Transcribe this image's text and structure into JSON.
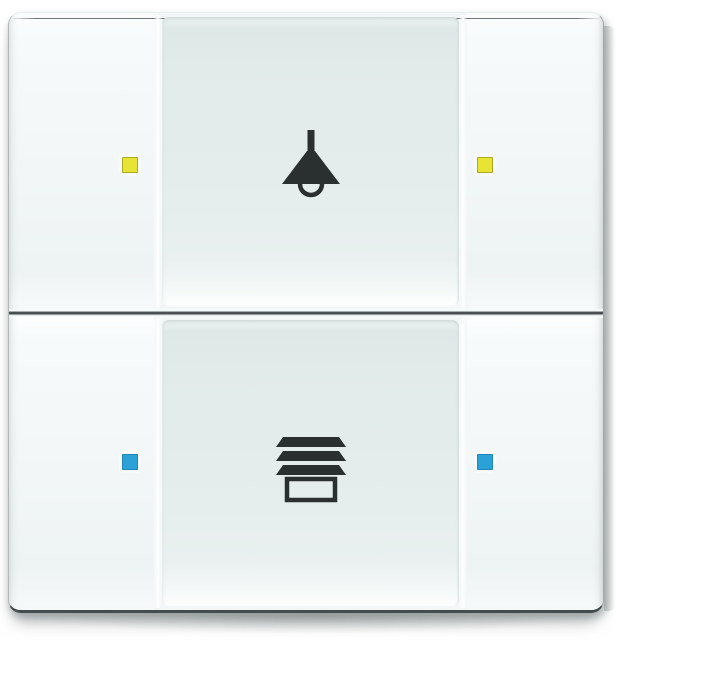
{
  "device": {
    "type": "knx-wall-switch",
    "description": "2-gang push-button wall sensor with status LEDs and labelled glass center fields",
    "colors": {
      "background": "#ffffff",
      "plate": "#f2f6f6",
      "button": "#f4f8f8",
      "center_field": "#e4edec",
      "icon": "#2a2f2f",
      "seam": "#3e4546",
      "edge": "#a6acac"
    },
    "rows": [
      {
        "name": "light-control-row",
        "icon": "pendant-lamp-icon",
        "led": {
          "name": "yellow-status-led",
          "fill": "#e7e433",
          "border": "#a9a724"
        },
        "buttons": [
          "left",
          "right"
        ]
      },
      {
        "name": "blinds-control-row",
        "icon": "blinds-icon",
        "led": {
          "name": "blue-status-led",
          "fill": "#2aa2d8",
          "border": "#1f86b8"
        },
        "buttons": [
          "left",
          "right"
        ]
      }
    ]
  }
}
